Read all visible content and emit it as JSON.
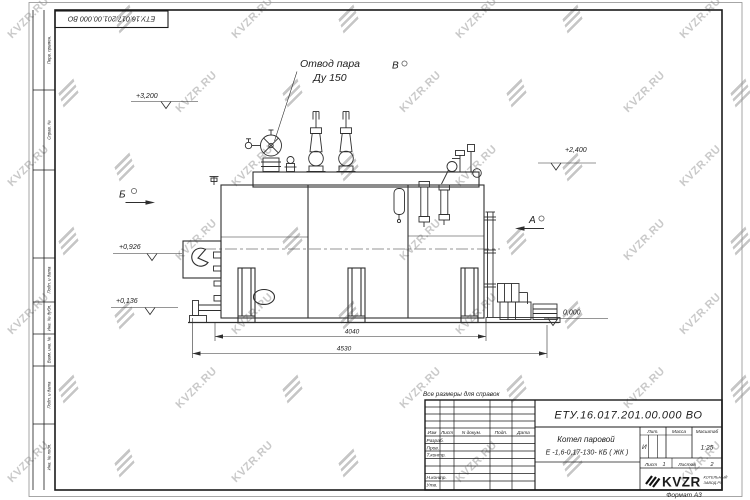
{
  "watermark": {
    "text": "KVZR.RU",
    "color": "#c9c9c9"
  },
  "sheet": {
    "top_stamp_number": "ЕТУ.16.017.201.00.000  ВО",
    "format_note": "Формат А3",
    "reference_note": "Все размеры для справок",
    "left_margin_labels": [
      "Перв. примен.",
      "Справ. №",
      "Подп. и дата",
      "Инв. № дубл.",
      "Взам. инв. №",
      "Подп. и дата",
      "Инв. № подл."
    ]
  },
  "drawing": {
    "steam_label_1": "Отвод пара",
    "steam_label_2": "Ду 150",
    "view_b": "Б",
    "view_v": "В",
    "view_a": "А",
    "elev_3200": "+3,200",
    "elev_2400": "+2,400",
    "elev_0926": "+0,926",
    "elev_0136": "+0,136",
    "elev_0": "0,000",
    "dim_4040": "4040",
    "dim_4530": "4530"
  },
  "title_block": {
    "doc_number": "ЕТУ.16.017.201.00.000  ВО",
    "product_line1": "Котел паровой",
    "product_line2": "Е -1,6-0,17-130- КБ ( ЖК )",
    "col_izm": "Изм",
    "col_list": "Лист",
    "col_ndoc": "N докум.",
    "col_podp": "Подп.",
    "col_data": "Дата",
    "row_razrab": "Разраб.",
    "row_prov": "Пров.",
    "row_tkontr": "Т.контр.",
    "row_nkontr": "Н.контр.",
    "row_utv": "Утв.",
    "lit_label": "Лит.",
    "mass_label": "Масса",
    "scale_label": "Масштаб",
    "lit_value": "И",
    "scale_value": "1:25",
    "sheet_label": "Лист",
    "sheet_num": "1",
    "sheets_label": "Листов",
    "sheets_num": "2",
    "logo_text": "KVZR",
    "logo_sub1": "КОТЕЛЬНЫЙ",
    "logo_sub2": "ЗАВОД.РУ"
  }
}
